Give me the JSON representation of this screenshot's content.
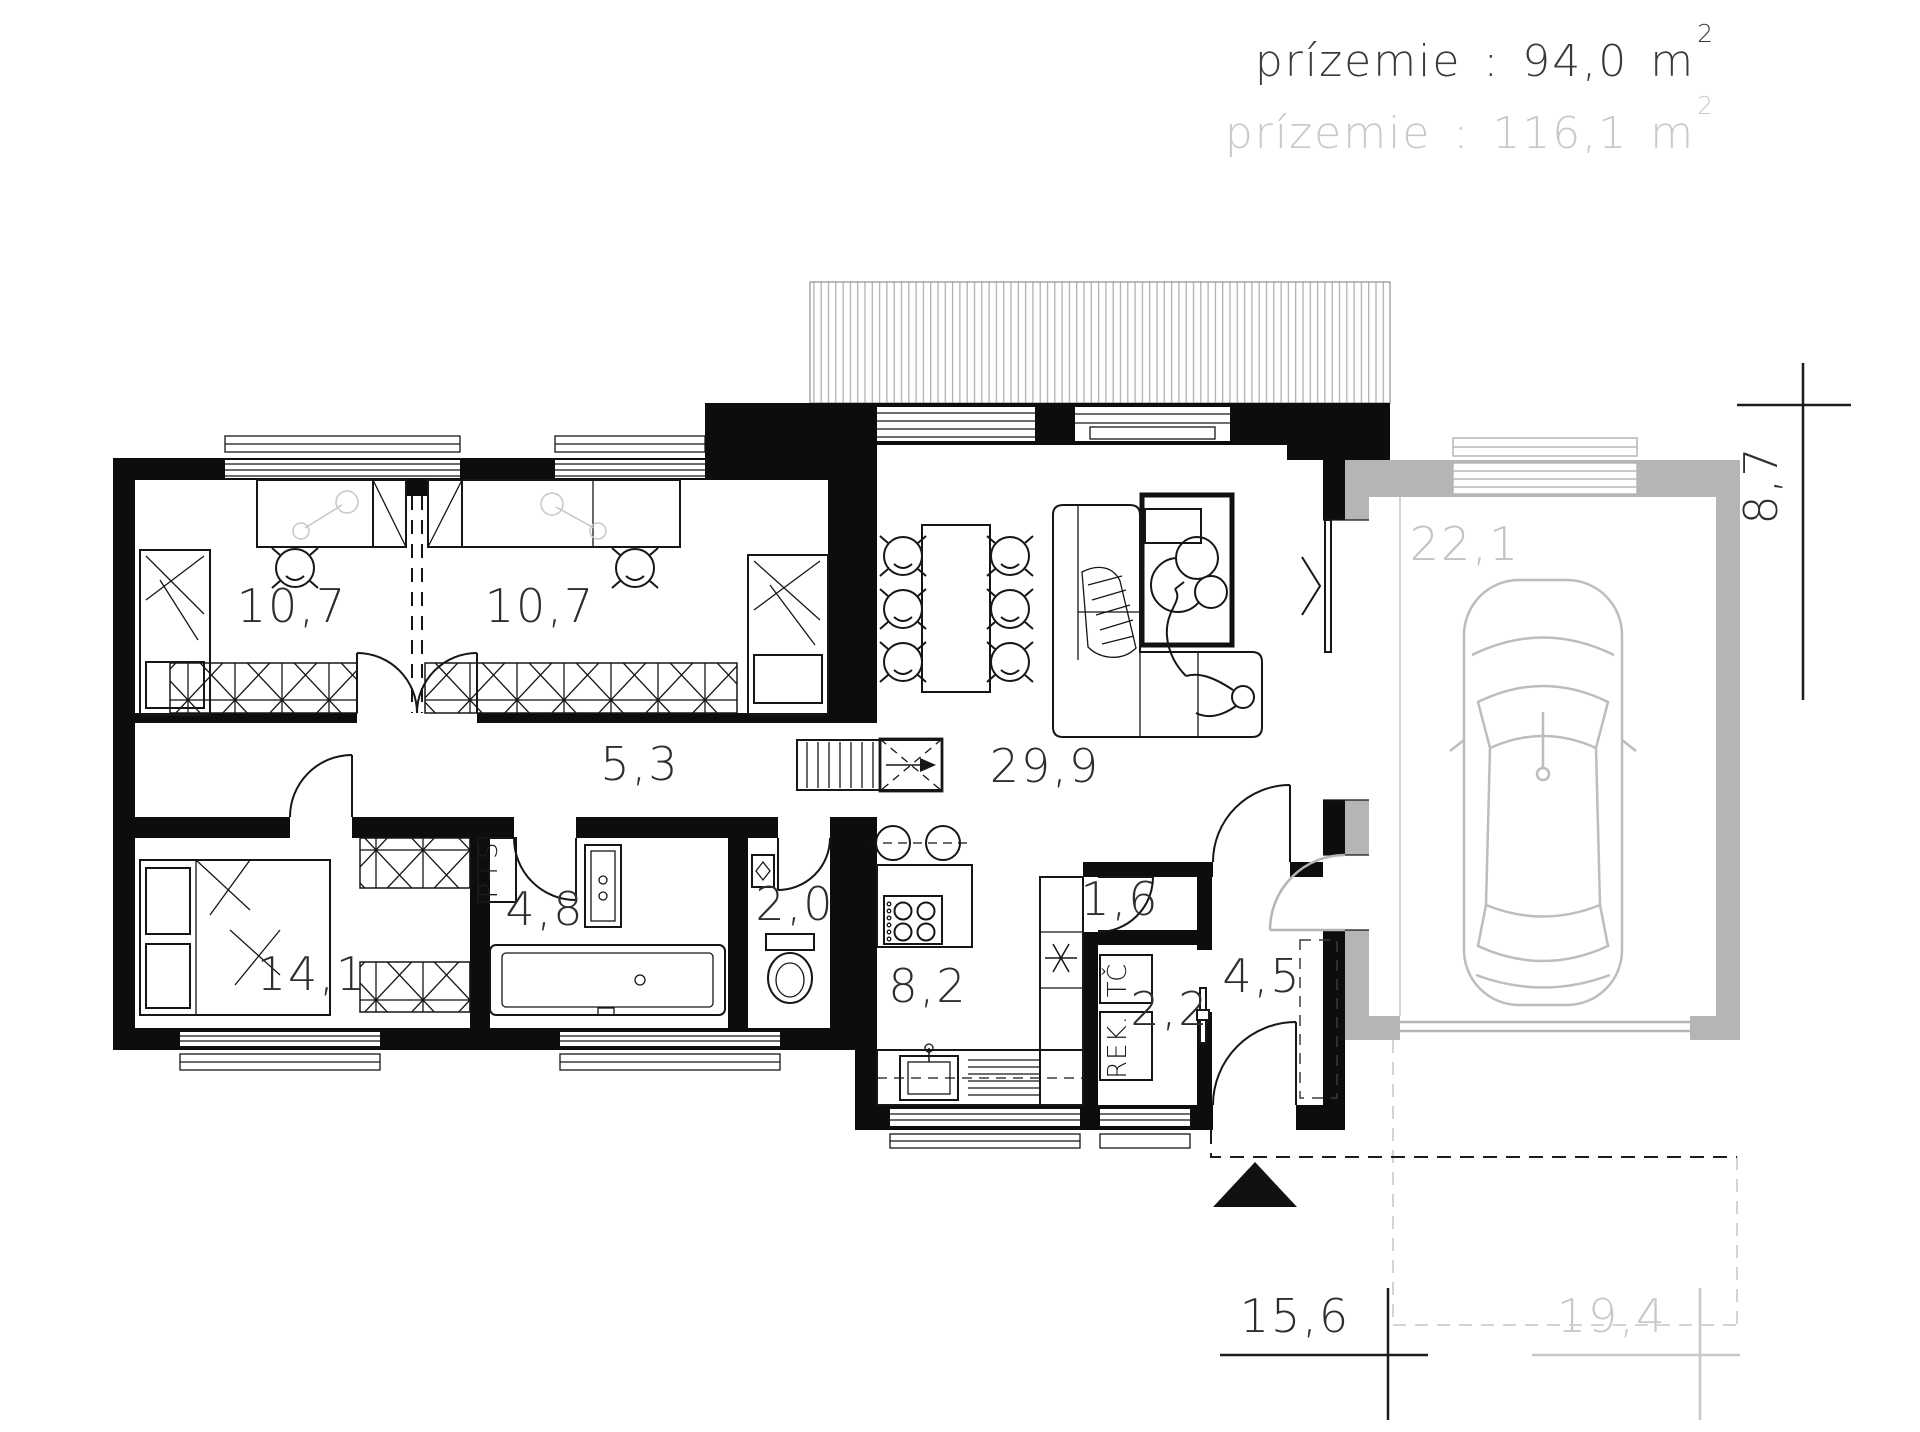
{
  "header": {
    "line1": {
      "label": "prízemie",
      "colon": ":",
      "value": "94,0",
      "unit": "m",
      "exponent": "2"
    },
    "line2": {
      "label": "prízemie",
      "colon": ":",
      "value": "116,1",
      "unit": "m",
      "exponent": "2"
    }
  },
  "rooms": {
    "bedroom1": "10,7",
    "bedroom2": "10,7",
    "bedroom3": "14,1",
    "corridor": "5,3",
    "bathroom": "4,8",
    "wc": "2,0",
    "kitchen": "8,2",
    "pantry": "1,6",
    "tech_room": "2,2",
    "entry_hall": "4,5",
    "living_room": "29,9",
    "garage": "22,1"
  },
  "equipment": {
    "washer_dryer": "P+S",
    "heat_pump": "TČ",
    "recuperation": "REK."
  },
  "icons": {
    "pantry_star": "six-ray-star-symbol",
    "entrance_marker": "black-triangle-up",
    "door_swing": "quarter-arc"
  },
  "dimensions": {
    "height_right": "8,7",
    "width_house": "15,6",
    "width_total": "19,4"
  },
  "colors": {
    "walls": "#0d0d0d",
    "optional_structure_gray": "#b5b5b5",
    "gray_labels": "#c3c3c3",
    "header_black": "#3a3a3a",
    "header_gray": "#c9c9c9"
  }
}
